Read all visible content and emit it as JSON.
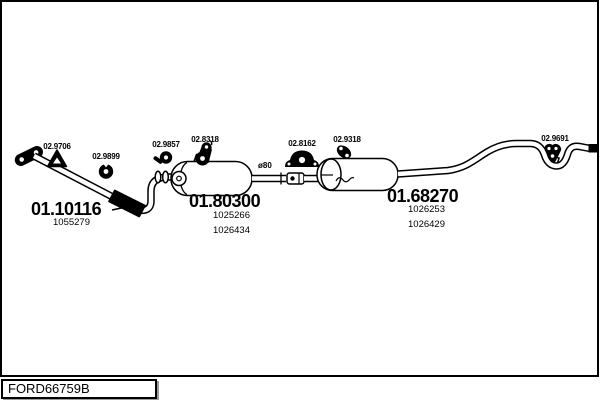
{
  "drawing_code": "FORD66759B",
  "diagram": {
    "pipe_diameter_label": "ø80",
    "main_parts": [
      {
        "name": "front-pipe",
        "label": "01.10116",
        "alt_numbers": [
          "1055279"
        ]
      },
      {
        "name": "centre-muffler",
        "label": "01.80300",
        "alt_numbers": [
          "1025266",
          "1026434"
        ]
      },
      {
        "name": "rear-muffler",
        "label": "01.68270",
        "alt_numbers": [
          "1026253",
          "1026429"
        ]
      }
    ],
    "fitting_parts": [
      {
        "name": "triangle-rubber-hanger",
        "label": "02.9706",
        "icon": "triangle-hanger-icon"
      },
      {
        "name": "rubber-grommet",
        "label": "02.9899",
        "icon": "grommet-icon"
      },
      {
        "name": "pipe-clamp",
        "label": "02.9857",
        "icon": "clamp-icon"
      },
      {
        "name": "rubber-hanger-front",
        "label": "02.8318",
        "icon": "rubber-hanger-icon"
      },
      {
        "name": "mounting-bracket",
        "label": "02.8162",
        "icon": "mount-bracket-icon"
      },
      {
        "name": "rubber-hanger-rear",
        "label": "02.9318",
        "icon": "rubber-hanger-icon"
      },
      {
        "name": "tail-rubber-hanger",
        "label": "02.9691",
        "icon": "tail-hanger-icon"
      }
    ],
    "colors": {
      "line": "#000000",
      "background": "#ffffff"
    }
  }
}
